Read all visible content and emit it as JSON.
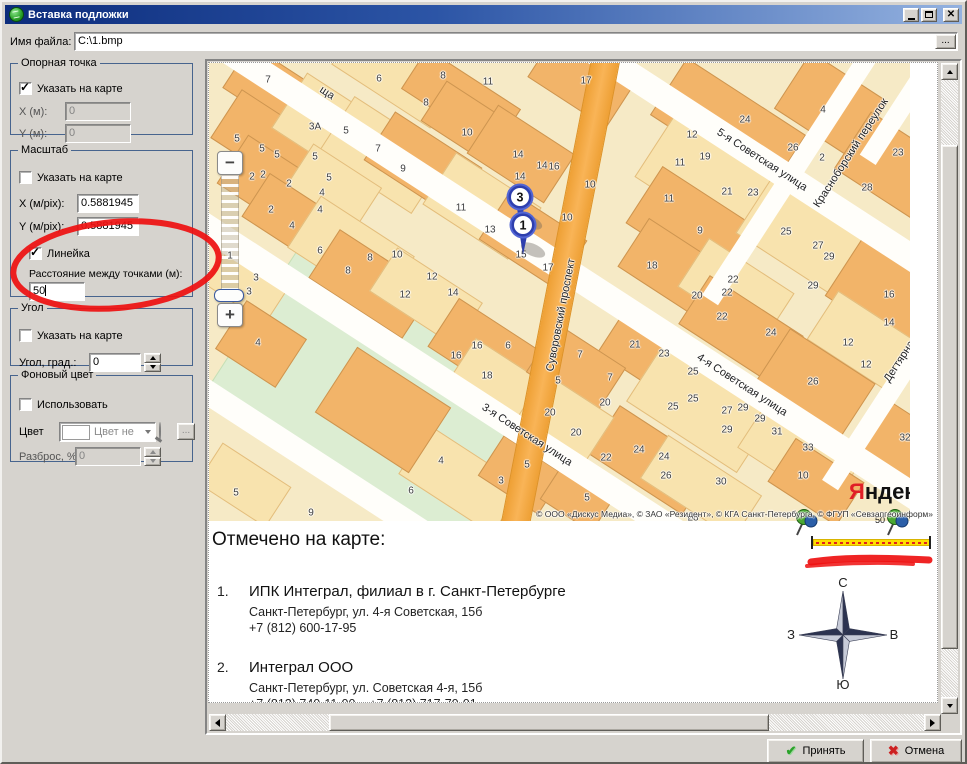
{
  "window": {
    "title": "Вставка подложки"
  },
  "titlebar": {
    "minimize": "свернуть",
    "maximize": "развернуть",
    "close": "закрыть"
  },
  "file_row": {
    "label": "Имя файла:",
    "value": "C:\\1.bmp",
    "browse": "..."
  },
  "anchor_group": {
    "legend": "Опорная точка",
    "pick_label": "Указать на карте",
    "pick_checked": true,
    "x_label": "X (м):",
    "x_value": "0",
    "y_label": "Y (м):",
    "y_value": "0"
  },
  "scale_group": {
    "legend": "Масштаб",
    "pick_label": "Указать на карте",
    "pick_checked": false,
    "x_label": "X (м/pix):",
    "x_value": "0.5881945",
    "y_label": "Y (м/pix):",
    "y_value": "0.5881945",
    "ruler_label": "Линейка",
    "ruler_checked": true,
    "distance_label": "Расстояние между точками (м):",
    "distance_value": "50"
  },
  "angle_group": {
    "legend": "Угол",
    "pick_label": "Указать на карте",
    "pick_checked": false,
    "value_label": "Угол, град.:",
    "value": "0"
  },
  "bg_group": {
    "legend": "Фоновый цвет",
    "use_label": "Использовать",
    "use_checked": false,
    "color_label": "Цвет",
    "color_combo_text": "Цвет не",
    "browse": "...",
    "spread_label": "Разброс, %:",
    "spread_value": "0"
  },
  "footer": {
    "accept": "Принять",
    "cancel": "Отмена"
  },
  "map": {
    "zoom_out": "−",
    "zoom_in": "+",
    "zoom_level": "1",
    "logo_first": "Я",
    "logo_rest": "ндекс",
    "copyright": "© ООО «Дискус Медиа», © ЗАО «Резидент», © КГА Санкт-Петербурга, © ФГУП «Севзапгеоинформ»",
    "markers": [
      {
        "label": "3",
        "x": 292,
        "y": 118
      },
      {
        "label": "1",
        "x": 295,
        "y": 146
      }
    ],
    "park": {
      "x": 20,
      "y": 250,
      "w": 330,
      "h": 180,
      "rot": 33
    },
    "streets": [
      {
        "cx": 520,
        "cy": 76,
        "len": 800,
        "w": 26,
        "rot": 33,
        "orange": false
      },
      {
        "cx": 369,
        "cy": 215,
        "len": 860,
        "w": 26,
        "rot": 33,
        "orange": false
      },
      {
        "cx": 350,
        "cy": 393,
        "len": 900,
        "w": 26,
        "rot": 33,
        "orange": false
      },
      {
        "cx": 95,
        "cy": 392,
        "len": 460,
        "w": 24,
        "rot": 33,
        "orange": false
      },
      {
        "cx": 350,
        "cy": 230,
        "len": 540,
        "w": 27,
        "rot": 101,
        "orange": true
      },
      {
        "cx": 580,
        "cy": 115,
        "len": 290,
        "w": 19,
        "rot": -57,
        "orange": false
      },
      {
        "cx": 700,
        "cy": 300,
        "len": 290,
        "w": 19,
        "rot": -57,
        "orange": false
      },
      {
        "cx": 705,
        "cy": 25,
        "len": 170,
        "w": 19,
        "rot": -57,
        "orange": false
      }
    ],
    "street_labels": [
      {
        "text": "ща",
        "x": 118,
        "y": 30,
        "rot": 33
      },
      {
        "text": "5-я Советская улица",
        "x": 553,
        "y": 97,
        "rot": 33
      },
      {
        "text": "Красноборский переулок",
        "x": 642,
        "y": 90,
        "rot": -57
      },
      {
        "text": "4-я Советская улица",
        "x": 533,
        "y": 322,
        "rot": 33
      },
      {
        "text": "Суворовский проспект",
        "x": 352,
        "y": 252,
        "rot": -79
      },
      {
        "text": "3-я Советская улица",
        "x": 318,
        "y": 372,
        "rot": 33
      },
      {
        "text": "Дегтярная",
        "x": 692,
        "y": 296,
        "rot": -57
      }
    ],
    "buildings": [
      [
        20,
        2,
        92,
        52,
        33,
        0
      ],
      [
        128,
        -18,
        118,
        56,
        33,
        1
      ],
      [
        196,
        12,
        112,
        48,
        33,
        0
      ],
      [
        326,
        -12,
        94,
        56,
        33,
        0
      ],
      [
        8,
        52,
        112,
        58,
        33,
        0
      ],
      [
        72,
        32,
        102,
        66,
        33,
        1
      ],
      [
        118,
        58,
        112,
        68,
        33,
        1
      ],
      [
        162,
        72,
        104,
        58,
        33,
        0
      ],
      [
        218,
        36,
        82,
        48,
        33,
        0
      ],
      [
        16,
        92,
        92,
        58,
        33,
        0
      ],
      [
        82,
        98,
        82,
        58,
        33,
        1
      ],
      [
        40,
        128,
        82,
        52,
        33,
        0
      ],
      [
        266,
        62,
        92,
        58,
        33,
        0
      ],
      [
        222,
        112,
        102,
        62,
        33,
        1
      ],
      [
        278,
        148,
        92,
        58,
        33,
        0
      ],
      [
        86,
        158,
        112,
        62,
        33,
        1
      ],
      [
        106,
        192,
        112,
        58,
        33,
        0
      ],
      [
        166,
        208,
        102,
        52,
        33,
        1
      ],
      [
        6,
        188,
        72,
        58,
        33,
        1
      ],
      [
        448,
        28,
        142,
        68,
        33,
        0
      ],
      [
        576,
        8,
        92,
        68,
        33,
        0
      ],
      [
        436,
        78,
        132,
        78,
        33,
        1
      ],
      [
        426,
        128,
        112,
        68,
        33,
        0
      ],
      [
        536,
        138,
        112,
        68,
        33,
        1
      ],
      [
        416,
        178,
        102,
        58,
        33,
        0
      ],
      [
        476,
        198,
        102,
        58,
        33,
        1
      ],
      [
        636,
        68,
        92,
        68,
        33,
        0
      ],
      [
        626,
        198,
        102,
        68,
        33,
        0
      ],
      [
        606,
        248,
        92,
        58,
        33,
        1
      ],
      [
        476,
        238,
        112,
        58,
        33,
        0
      ],
      [
        396,
        263,
        112,
        62,
        33,
        0
      ],
      [
        426,
        308,
        132,
        72,
        33,
        1
      ],
      [
        556,
        288,
        102,
        62,
        33,
        0
      ],
      [
        536,
        358,
        112,
        62,
        33,
        1
      ],
      [
        386,
        368,
        112,
        58,
        33,
        0
      ],
      [
        436,
        398,
        112,
        52,
        33,
        1
      ],
      [
        566,
        393,
        82,
        52,
        33,
        0
      ],
      [
        652,
        348,
        72,
        58,
        33,
        0
      ],
      [
        16,
        252,
        72,
        58,
        33,
        0
      ],
      [
        226,
        258,
        102,
        58,
        33,
        0
      ],
      [
        246,
        293,
        82,
        52,
        33,
        1
      ],
      [
        326,
        278,
        82,
        58,
        33,
        0
      ],
      [
        316,
        328,
        82,
        52,
        33,
        1
      ],
      [
        196,
        388,
        112,
        58,
        33,
        1
      ],
      [
        276,
        388,
        72,
        48,
        33,
        0
      ],
      [
        -6,
        398,
        82,
        48,
        33,
        1
      ],
      [
        118,
        308,
        112,
        78,
        33,
        0
      ],
      [
        336,
        418,
        62,
        38,
        33,
        0
      ]
    ],
    "house_numbers": [
      [
        "7",
        59,
        17
      ],
      [
        "6",
        170,
        16
      ],
      [
        "8",
        234,
        13
      ],
      [
        "11",
        279,
        19
      ],
      [
        "17",
        377,
        18
      ],
      [
        "8",
        217,
        40
      ],
      [
        "3А",
        106,
        64
      ],
      [
        "5",
        137,
        68
      ],
      [
        "10",
        258,
        70
      ],
      [
        "5",
        28,
        76
      ],
      [
        "5",
        53,
        86
      ],
      [
        "5",
        68,
        92
      ],
      [
        "5",
        106,
        94
      ],
      [
        "7",
        169,
        86
      ],
      [
        "14",
        309,
        92
      ],
      [
        "9",
        194,
        106
      ],
      [
        "14",
        333,
        103
      ],
      [
        "16",
        345,
        104
      ],
      [
        "2",
        43,
        114
      ],
      [
        "2",
        54,
        112
      ],
      [
        "14",
        311,
        114
      ],
      [
        "10",
        381,
        122
      ],
      [
        "2",
        80,
        121
      ],
      [
        "5",
        120,
        115
      ],
      [
        "4",
        113,
        130
      ],
      [
        "11",
        252,
        145
      ],
      [
        "10",
        358,
        155
      ],
      [
        "2",
        62,
        147
      ],
      [
        "4",
        111,
        147
      ],
      [
        "13",
        281,
        167
      ],
      [
        "4",
        83,
        163
      ],
      [
        "6",
        111,
        188
      ],
      [
        "8",
        161,
        195
      ],
      [
        "10",
        188,
        192
      ],
      [
        "8",
        139,
        208
      ],
      [
        "12",
        223,
        214
      ],
      [
        "14",
        244,
        230
      ],
      [
        "12",
        196,
        232
      ],
      [
        "3",
        47,
        215
      ],
      [
        "3",
        40,
        229
      ],
      [
        "17",
        339,
        205
      ],
      [
        "15",
        312,
        192
      ],
      [
        "12",
        483,
        72
      ],
      [
        "24",
        536,
        57
      ],
      [
        "4",
        614,
        47
      ],
      [
        "11",
        471,
        100
      ],
      [
        "19",
        496,
        94
      ],
      [
        "26",
        584,
        85
      ],
      [
        "2",
        613,
        95
      ],
      [
        "23",
        689,
        90
      ],
      [
        "21",
        518,
        129
      ],
      [
        "23",
        544,
        130
      ],
      [
        "28",
        658,
        125
      ],
      [
        "11",
        460,
        136
      ],
      [
        "9",
        491,
        168
      ],
      [
        "25",
        577,
        169
      ],
      [
        "27",
        609,
        183
      ],
      [
        "29",
        620,
        194
      ],
      [
        "18",
        443,
        203
      ],
      [
        "22",
        524,
        217
      ],
      [
        "20",
        488,
        233
      ],
      [
        "29",
        604,
        223
      ],
      [
        "16",
        680,
        232
      ],
      [
        "22",
        518,
        230
      ],
      [
        "22",
        513,
        254
      ],
      [
        "24",
        562,
        270
      ],
      [
        "14",
        680,
        260
      ],
      [
        "21",
        426,
        282
      ],
      [
        "23",
        455,
        291
      ],
      [
        "12",
        639,
        280
      ],
      [
        "25",
        484,
        309
      ],
      [
        "12",
        657,
        302
      ],
      [
        "26",
        604,
        319
      ],
      [
        "7",
        401,
        315
      ],
      [
        "20",
        396,
        340
      ],
      [
        "25",
        464,
        344
      ],
      [
        "25",
        484,
        336
      ],
      [
        "27",
        518,
        348
      ],
      [
        "29",
        534,
        345
      ],
      [
        "29",
        551,
        356
      ],
      [
        "29",
        518,
        367
      ],
      [
        "31",
        568,
        369
      ],
      [
        "33",
        599,
        385
      ],
      [
        "32",
        696,
        375
      ],
      [
        "24",
        430,
        387
      ],
      [
        "24",
        455,
        394
      ],
      [
        "22",
        397,
        395
      ],
      [
        "26",
        457,
        413
      ],
      [
        "30",
        512,
        419
      ],
      [
        "10",
        594,
        413
      ],
      [
        "28",
        484,
        455
      ],
      [
        "4",
        49,
        280
      ],
      [
        "16",
        268,
        283
      ],
      [
        "16",
        247,
        293
      ],
      [
        "6",
        299,
        283
      ],
      [
        "18",
        278,
        313
      ],
      [
        "7",
        371,
        292
      ],
      [
        "5",
        349,
        318
      ],
      [
        "20",
        341,
        350
      ],
      [
        "20",
        367,
        370
      ],
      [
        "4",
        232,
        398
      ],
      [
        "3",
        292,
        418
      ],
      [
        "5",
        318,
        402
      ],
      [
        "6",
        202,
        428
      ],
      [
        "5",
        27,
        430
      ],
      [
        "9",
        102,
        450
      ],
      [
        "5",
        378,
        435
      ]
    ]
  },
  "legend_panel": {
    "title": "Отмечено на карте:",
    "scale_value": "50",
    "items": [
      {
        "num": "1.",
        "name": "ИПК Интеграл, филиал в г. Санкт-Петербурге",
        "address": "Санкт-Петербург, ул. 4-я Советская, 15б",
        "phones": "+7 (812) 600-17-95"
      },
      {
        "num": "2.",
        "name": "Интеграл ООО",
        "address": "Санкт-Петербург, ул. Советская 4-я, 15б",
        "phones": "+7 (812) 740-11-00    +7 (812) 717-70-01"
      }
    ],
    "compass": {
      "north": "С",
      "south": "Ю",
      "west": "З",
      "east": "В"
    }
  },
  "colors": {
    "accent_red": "#ee1111",
    "street_orange": "#f6a93e",
    "building": "#f2b469",
    "building_pale": "#f8e3ae",
    "park": "#dcedd2",
    "marker_blue": "#3748b4",
    "ruler_yellow": "#ffdf00"
  }
}
